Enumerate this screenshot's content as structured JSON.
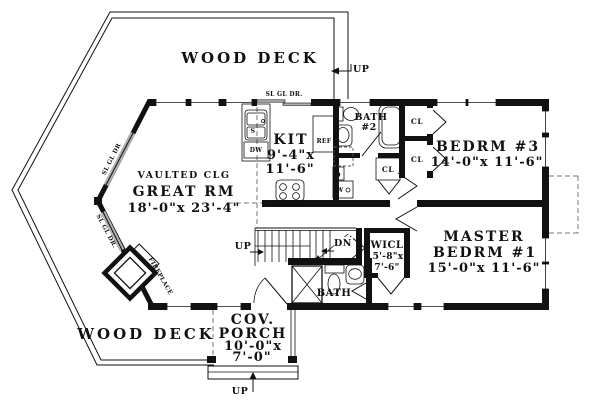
{
  "title": "Single level house floor plan",
  "colors": {
    "ink": "#111111",
    "paper": "#ffffff",
    "slider_gray": "#b0b0b0",
    "dash_gray": "#777777"
  },
  "rooms": {
    "deck_top": {
      "name": "WOOD DECK"
    },
    "deck_bottom": {
      "name": "WOOD DECK"
    },
    "great_room": {
      "ceiling": "VAULTED CLG",
      "name": "GREAT RM",
      "dims": "18'-0\"x 23'-4\""
    },
    "kitchen": {
      "name": "KIT",
      "dims1": "9'-4\"x",
      "dims2": "11'-6\""
    },
    "bath2": {
      "name1": "BATH",
      "name2": "#2"
    },
    "bedrm3": {
      "name": "BEDRM #3",
      "dims": "14'-0\"x 11'-6\""
    },
    "master": {
      "name1": "MASTER",
      "name2": "BEDRM #1",
      "dims": "15'-0\"x 11'-6\""
    },
    "wicl": {
      "name": "WICL",
      "dims1": "5'-8\"x",
      "dims2": "7'-6\""
    },
    "master_bath": {
      "name": "BATH"
    },
    "porch": {
      "name1": "COV.",
      "name2": "PORCH",
      "dims1": "10'-0\"x",
      "dims2": "7'-0\""
    }
  },
  "labels": {
    "up_deck": "UP",
    "up_stairs": "UP",
    "dn_stairs": "DN",
    "up_porch": "UP",
    "sl_gl_dr_top": "SL GL DR.",
    "sl_gl_dr_upper": "SL GL DR",
    "sl_gl_dr_lower": "SL GL DR.",
    "fireplace": "FIREPLACE",
    "ref": "REF",
    "sink": "S",
    "dishwasher": "DW",
    "dryer": "D",
    "washer": "W",
    "cl_a": "CL",
    "cl_b": "CL",
    "cl_c": "CL"
  }
}
